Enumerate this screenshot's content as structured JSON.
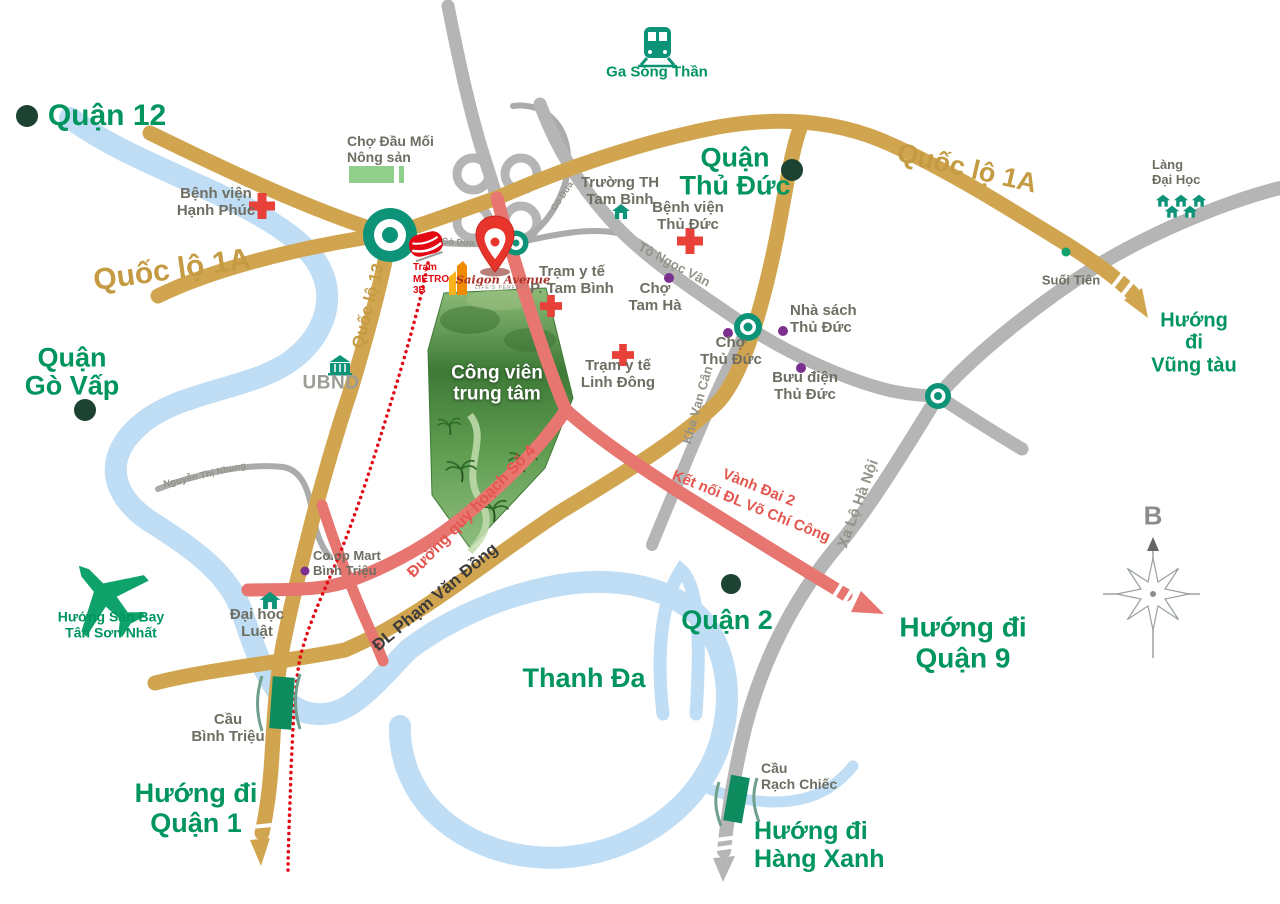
{
  "districts": {
    "quan_12": "Quận 12",
    "quan_thu_duc": "Quận\nThủ Đức",
    "quan_go_vap": "Quận\nGò Vấp",
    "quan_2": "Quận 2",
    "thanh_da": "Thanh Đa"
  },
  "directions": {
    "vung_tau": "Hướng đi\nVũng tàu",
    "quan_9": "Hướng đi\nQuận 9",
    "hang_xanh": "Hướng đi\nHàng Xanh",
    "quan_1": "Hướng đi\nQuận 1",
    "tan_son_nhat": "Hướng Sân Bay\nTân Sơn Nhất"
  },
  "roads": {
    "ql1a": "Quốc lộ 1A",
    "ql13": "Quốc lộ 13",
    "pham_van_dong": "ĐL Phạm Văn Đồng",
    "quy_hoach_so_4": "Đường quy hoạch Số 4",
    "vanh_dai_2": "Vành Đai 2\nKết nối ĐL Võ Chí Công",
    "xa_lo_ha_noi": "Xa Lộ Hà Nội",
    "kha_van_can": "Kha Vạn Cân",
    "to_ngoc_van": "Tô Ngọc Vân",
    "go_dua": "Gò Dưa",
    "nguyen_thi_nhung": "Nguyễn Thị Nhung"
  },
  "pois": {
    "ga_song_than": "Ga Sóng Thần",
    "cho_dau_moi": "Chợ Đầu Mối\nNông sản",
    "benh_vien_hanh_phuc": "Bệnh viện\nHạnh Phúc",
    "truong_th_tam_binh": "Trường TH\nTam Bình",
    "benh_vien_thu_duc": "Bệnh viện\nThủ Đức",
    "tram_y_te_tam_binh": "Trạm y tế\nP. Tam Bình",
    "cho_tam_ha": "Chợ\nTam Hà",
    "nha_sach_thu_duc": "Nhà sách\nThủ Đức",
    "cho_thu_duc": "Chợ\nThủ Đức",
    "buu_dien_thu_duc": "Bưu điện\nThủ Đức",
    "tram_y_te_linh_dong": "Trạm y tế\nLinh Đông",
    "lang_dai_hoc": "Làng\nĐại Học",
    "suoi_tien": "Suối Tiên",
    "ubnd": "UBND",
    "tram_metro_3b": "Trạm\nMETRO\n3B",
    "coop_mart": "Co.op Mart\nBình Triệu",
    "dai_hoc_luat": "Đại học\nLuật",
    "cau_binh_trieu": "Cầu\nBình Triệu",
    "cau_rach_chiec": "Cầu\nRạch Chiếc",
    "cong_vien_trung_tam": "Công viên\ntrung tâm"
  },
  "project": {
    "name": "Saigon Avenue",
    "tagline": "LIFE'S PERFECT"
  },
  "compass": {
    "north": "B"
  },
  "icons": {
    "railway-station-icon": "train front glyph",
    "metro-train-icon": "red metro train glyph",
    "hospital-cross-icon": "red cross",
    "clinic-cross-icon": "red cross (small)",
    "market-icon": "green rectangles",
    "school-icon": "green house",
    "university-village-icon": "five green houses",
    "ubnd-building-icon": "green government building",
    "airplane-icon": "green airplane silhouette",
    "bridge-icon": "green bridge rectangle with brackets",
    "location-pin-icon": "red map pin",
    "roundabout-icon": "teal ring with dot",
    "compass-rose-icon": "gray wind rose with north arrow",
    "district-dot-icon": "dark green dot",
    "poi-dot-icon": "purple dot"
  },
  "colors": {
    "label_green": "#00945E",
    "road_gold": "#D1A54F",
    "road_gray": "#B5B5B5",
    "road_red": "#E77570",
    "metro_dotted_red": "#E30613",
    "river_blue": "#BFDDF4",
    "poi_text_gray": "#6E6E63",
    "marker_purple": "#7B2F8F",
    "roundabout_teal": "#0D9478",
    "cross_red": "#E8413A",
    "pin_red": "#E8352B",
    "district_dot_green": "#1C4332",
    "bridge_green": "#0E8C60"
  }
}
